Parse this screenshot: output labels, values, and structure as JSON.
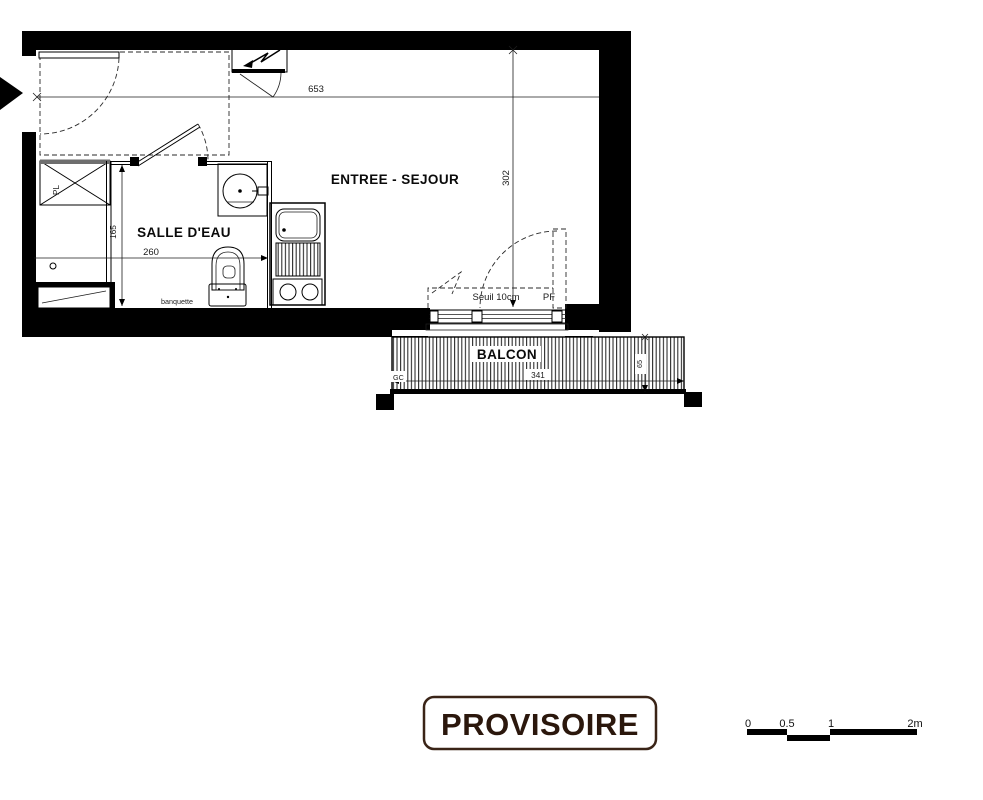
{
  "plan": {
    "rooms": {
      "living": "ENTREE - SEJOUR",
      "bathroom": "SALLE D'EAU",
      "balcony": "BALCON"
    },
    "dims": {
      "total_width": "653",
      "total_depth": "302",
      "bathroom_width": "260",
      "bathroom_depth": "165",
      "balcony_width": "341",
      "balcony_depth": "65"
    },
    "labels": {
      "threshold": "Seuil 10cm",
      "window": "PF",
      "bench": "banquette",
      "gc": "GC",
      "closet": "PL"
    }
  },
  "stamp": {
    "label": "PROVISOIRE"
  },
  "scale_bar": {
    "ticks": [
      "0",
      "0.5",
      "1",
      "2m"
    ]
  },
  "colors": {
    "ink": "#000000",
    "stamp_ink": "#2b170c"
  }
}
